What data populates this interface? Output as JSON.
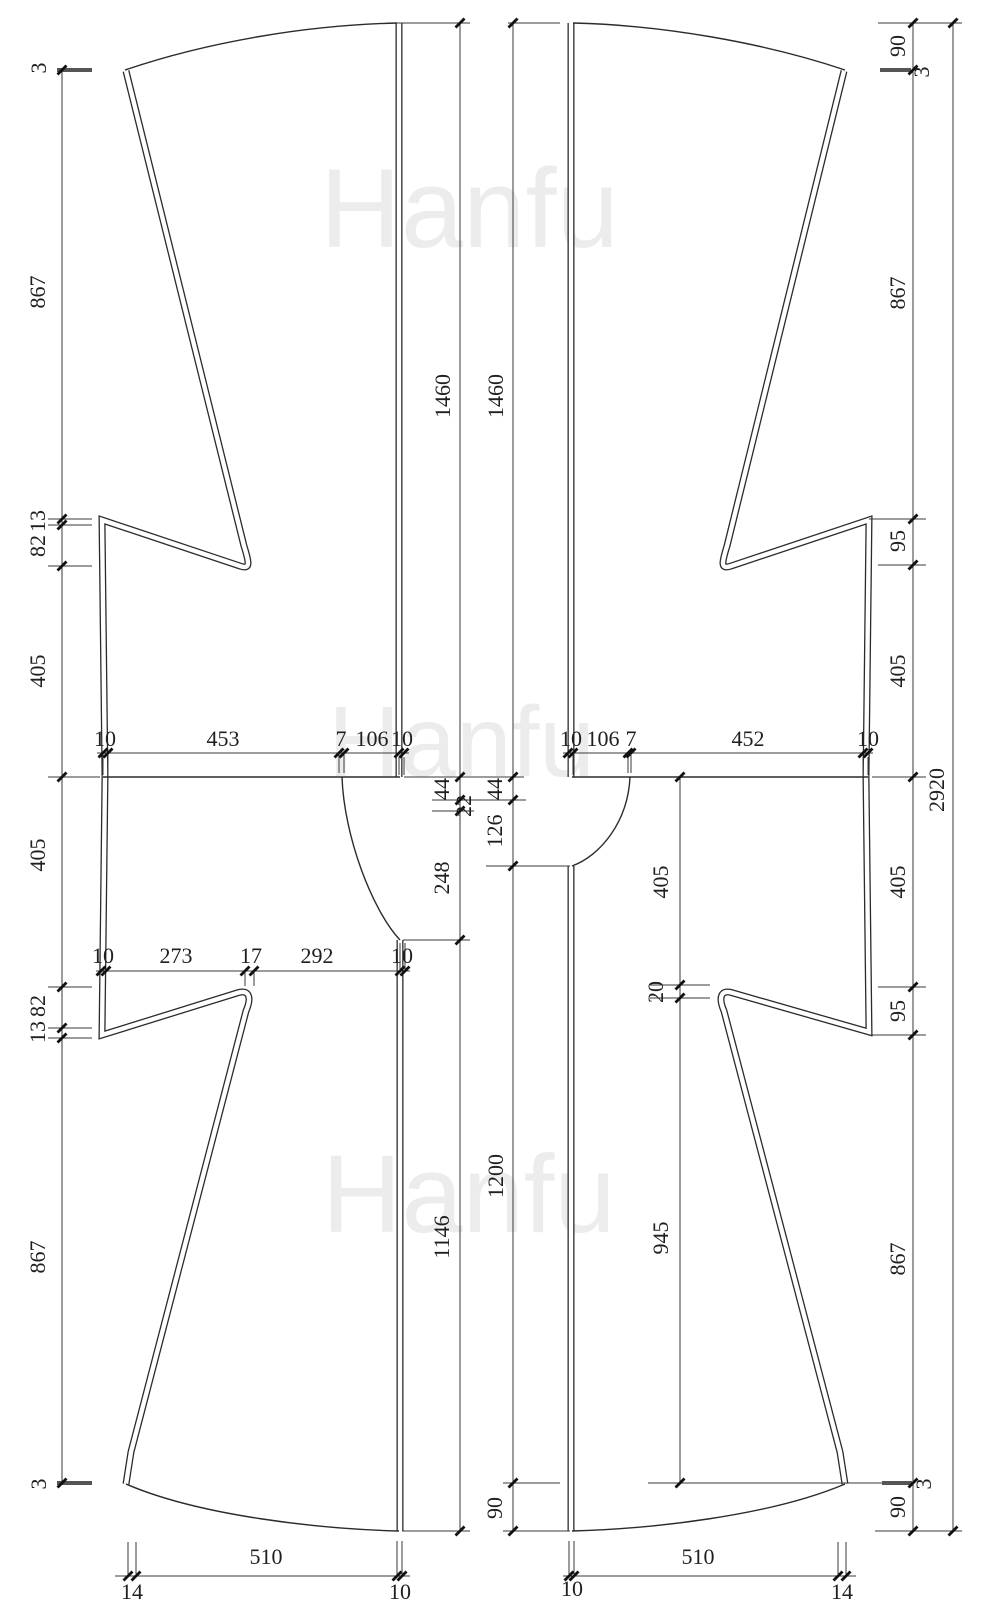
{
  "watermark": {
    "text": "Hanfu",
    "color": "#ececec"
  },
  "drawing": {
    "type": "sewing-pattern",
    "pieces": [
      "left-body-panel",
      "right-body-panel"
    ]
  },
  "dims": {
    "left_col": [
      "3",
      "867",
      "13",
      "82",
      "405",
      "405",
      "82",
      "13",
      "867",
      "3"
    ],
    "right_col": [
      "90",
      "3",
      "867",
      "95",
      "405",
      "405",
      "95",
      "867",
      "90",
      "3"
    ],
    "total_height": "2920",
    "center_left": [
      "1460",
      "44",
      "22",
      "248",
      "1146"
    ],
    "center_right": [
      "1460",
      "44",
      "126",
      "1200",
      "90"
    ],
    "inner_right": [
      "405",
      "20",
      "945"
    ],
    "waist_left": [
      "10",
      "453",
      "7",
      "106",
      "10"
    ],
    "waist_right": [
      "10",
      "106",
      "7",
      "452",
      "10"
    ],
    "hip_left": [
      "10",
      "273",
      "17",
      "292",
      "10"
    ],
    "hem_left": [
      "14",
      "510",
      "10"
    ],
    "hem_right": [
      "10",
      "510",
      "14"
    ]
  }
}
